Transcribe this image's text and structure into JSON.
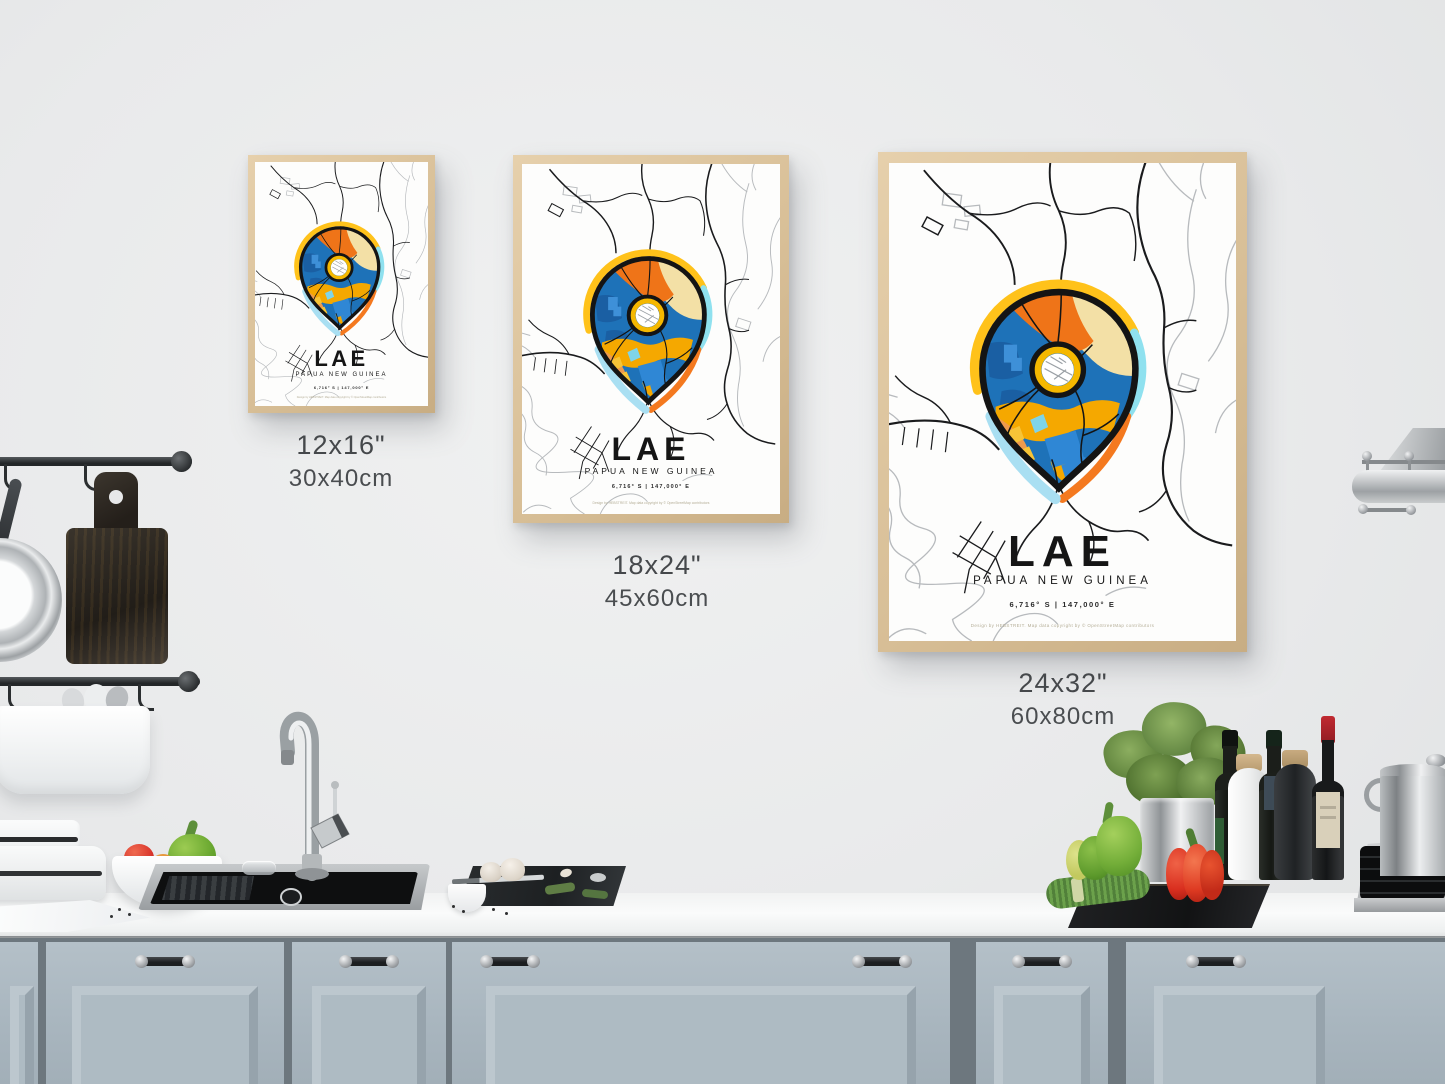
{
  "poster": {
    "title": "LAE",
    "subtitle": "PAPUA NEW GUINEA",
    "coordinates": "6,716° S | 147,000° E",
    "credit": "Design by HEBSTREIT. Map data copyright by © OpenStreetMap contributors"
  },
  "sizes": [
    {
      "inches": "12x16\"",
      "cm": "30x40cm"
    },
    {
      "inches": "18x24\"",
      "cm": "45x60cm"
    },
    {
      "inches": "24x32\"",
      "cm": "60x80cm"
    }
  ],
  "palette": {
    "pin_blue": "#1E72B8",
    "pin_orange": "#EF7418",
    "pin_cream": "#F3E0A6",
    "pin_gold": "#F5A800",
    "pin_salmon": "#EE9A4D",
    "halo_gold": "#FFC21A",
    "halo_cyan": "#8FE1EF",
    "halo_ice": "#A9DFF2",
    "frame_wood": "#D8BF97",
    "cabinet_blue_gray": "#AEBBC3"
  }
}
